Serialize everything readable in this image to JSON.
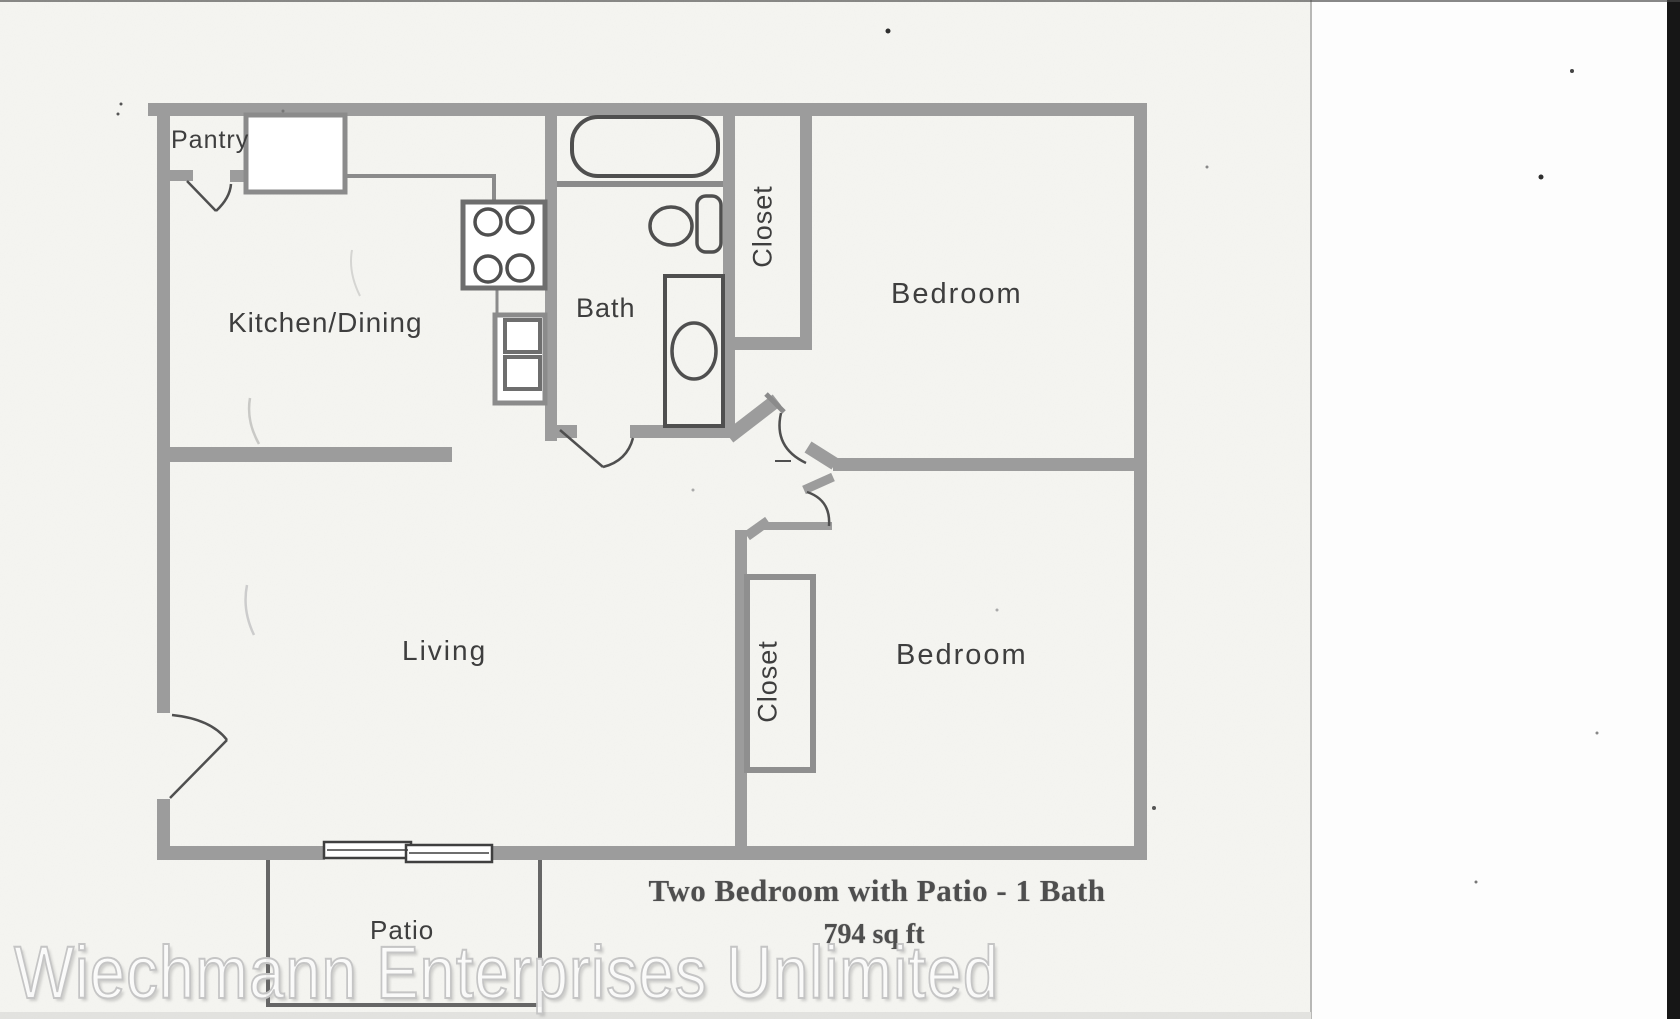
{
  "document": {
    "type": "scanned floor plan",
    "caption": {
      "line1": "Two Bedroom with Patio - 1 Bath",
      "line2": "794 sq ft"
    },
    "watermark": "Wiechmann Enterprises Unlimited"
  },
  "room_labels": {
    "pantry": "Pantry",
    "kitchen_dining": "Kitchen/Dining",
    "bath": "Bath",
    "closet_top": "Closet",
    "bedroom_top": "Bedroom",
    "living": "Living",
    "closet_bottom": "Closet",
    "bedroom_bottom": "Bedroom",
    "patio": "Patio"
  },
  "fixtures": [
    "bathtub",
    "toilet",
    "vanity-sink",
    "stove-cooktop",
    "kitchen-sink",
    "upper-cabinet",
    "counter",
    "pantry-door",
    "front-door",
    "bath-door",
    "bedroom-doors",
    "sliding-patio-door",
    "closet-top",
    "closet-bottom",
    "patio-rail"
  ],
  "colors": {
    "wall": "#9c9c9c",
    "wall_light": "#8b8b8b",
    "line": "#4f4f4f",
    "paper": "#f5f5f1",
    "paper_edge": "#b8b8b6",
    "scanner_white": "#fdfdfd",
    "scanner_bar": "#161616",
    "label": "#3e3e3e",
    "caption": "#4e4e4e",
    "watermark_stroke": "#c5c5c5"
  }
}
